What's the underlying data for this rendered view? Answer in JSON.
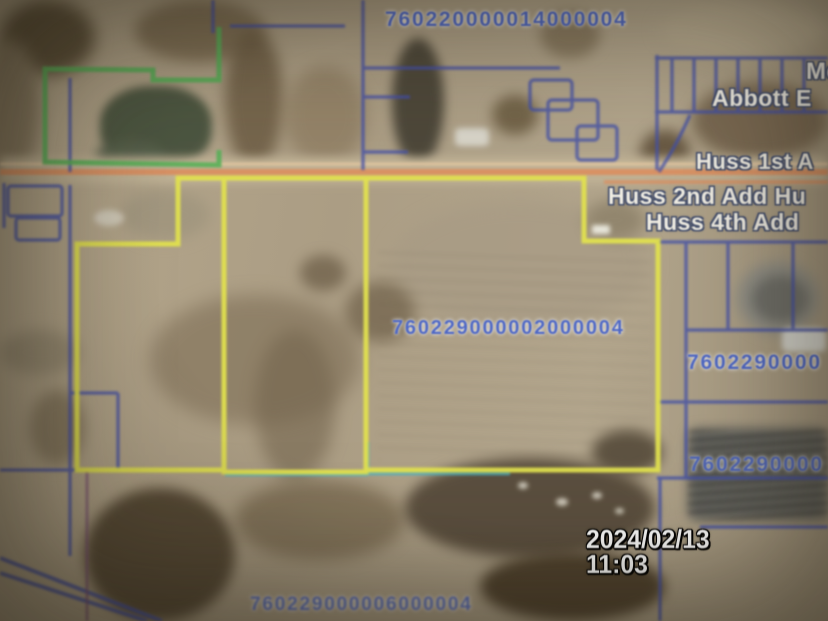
{
  "labels": {
    "parcel_top": "760220000014000004",
    "parcel_center": "760229000002000004",
    "parcel_right_upper": "7602290000",
    "parcel_right_lower": "7602290000",
    "parcel_bottom": "760229000006000004",
    "place_mc": "Mc",
    "place_abbott": "Abbott E",
    "place_huss_1st": "Huss 1st A",
    "place_huss_2nd": "Huss 2nd Add Hu",
    "place_huss_4th": "Huss 4th Add"
  },
  "timestamp": {
    "date": "2024/02/13",
    "time": "11:03"
  },
  "colors": {
    "boundary_yellow": "#e2e24e",
    "boundary_blue": "#4350a8",
    "boundary_green": "#58b058",
    "boundary_cyan": "#49b4c4",
    "road_orange": "#df8a58",
    "parcel_number_blue": "#4f68c4",
    "label_white": "#f0ede3",
    "timestamp_white": "#fdfdfd"
  }
}
